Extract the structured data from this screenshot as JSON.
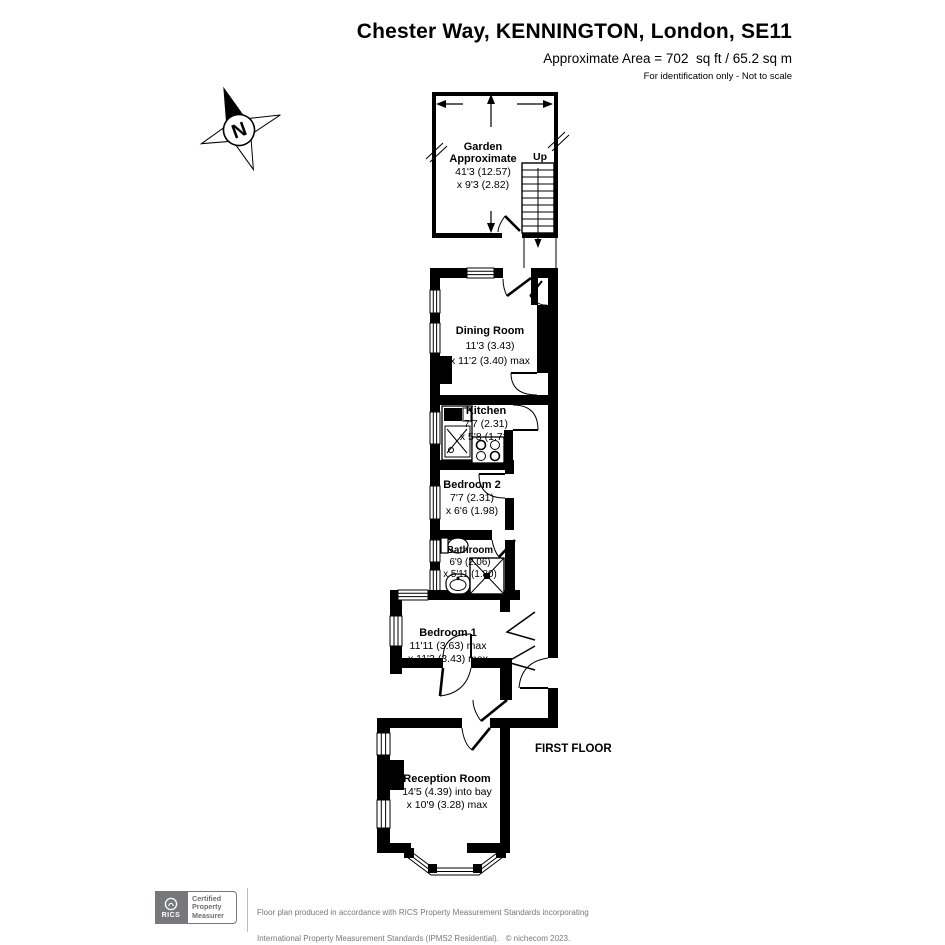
{
  "header": {
    "title": "Chester Way, KENNINGTON, London, SE11",
    "area": "Approximate Area = 702  sq ft / 65.2 sq m",
    "note": "For identification only - Not to scale"
  },
  "compass": {
    "label": "N"
  },
  "plan": {
    "floor_label": "FIRST FLOOR",
    "garden": {
      "name": "Garden",
      "name2": "Approximate",
      "dim1": "41'3 (12.57)",
      "dim2": "x 9'3 (2.82)",
      "stairs_label": "Up"
    },
    "rooms": [
      {
        "name": "Dining Room",
        "dim1": "11'3 (3.43)",
        "dim2": "x 11'2 (3.40) max"
      },
      {
        "name": "Kitchen",
        "dim1": "7'7 (2.31)",
        "dim2": "x 5'8 (1.73)"
      },
      {
        "name": "Bedroom 2",
        "dim1": "7'7 (2.31)",
        "dim2": "x 6'6 (1.98)"
      },
      {
        "name": "Bathroom",
        "dim1": "6'9 (2.06)",
        "dim2": "x 5'11 (1.80)"
      },
      {
        "name": "Bedroom 1",
        "dim1": "11'11 (3.63) max",
        "dim2": "x 11'3 (3.43) max"
      },
      {
        "name": "Reception Room",
        "dim1": "14'5 (4.39) into bay",
        "dim2": "x 10'9 (3.28) max"
      }
    ]
  },
  "footer": {
    "rics_label": "RICS",
    "badge": {
      "line1": "Certified",
      "line2": "Property",
      "line3": "Measurer"
    },
    "line1": "Floor plan produced in accordance with RICS Property Measurement Standards incorporating",
    "line2": "International Property Measurement Standards (IPMS2 Residential).   © nichecom 2023.",
    "line3": "Produced for L&Q Group.   REF:  990433"
  },
  "colors": {
    "wall": "#000000",
    "gray": "#77787b"
  }
}
